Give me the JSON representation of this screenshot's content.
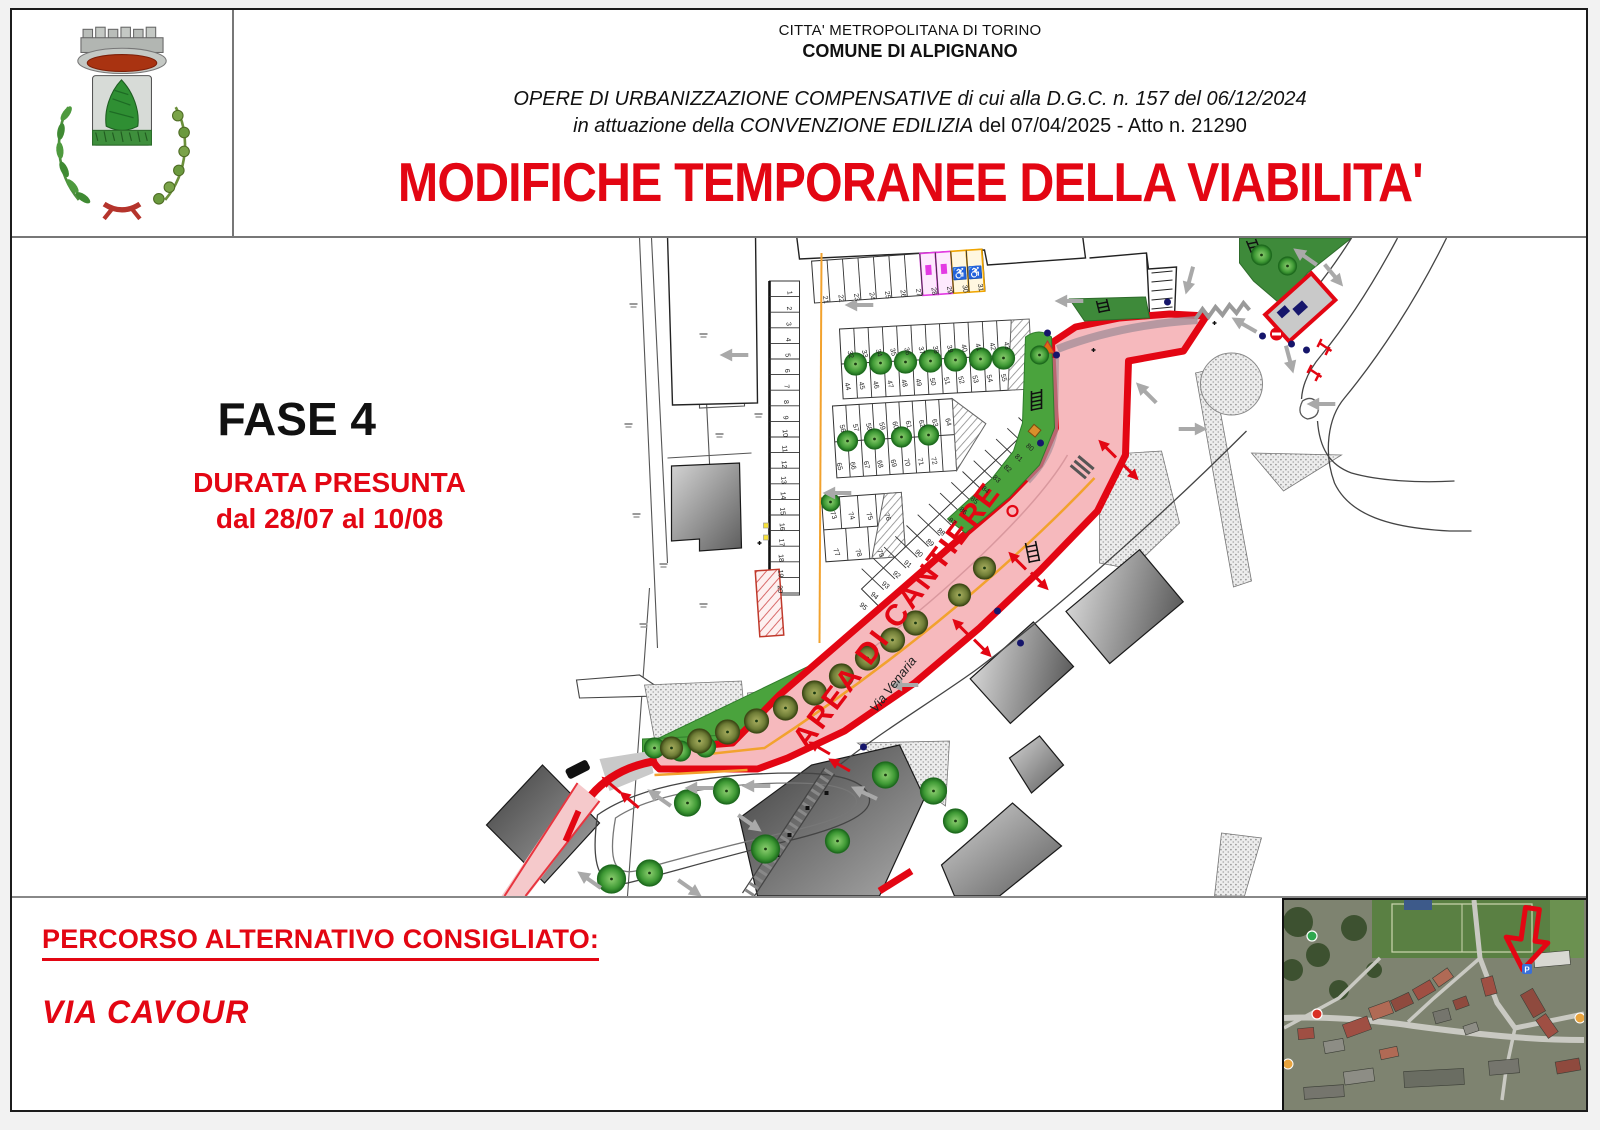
{
  "header": {
    "region_line": "CITTA' METROPOLITANA DI TORINO",
    "municipality_line": "COMUNE DI ALPIGNANO",
    "works_line": "OPERE DI URBANIZZAZIONE COMPENSATIVE di cui alla D.G.C. n. 157 del 06/12/2024",
    "agreement_line_italic": "in attuazione della CONVENZIONE EDILIZIA",
    "agreement_line_regular": "del 07/04/2025 - Atto n. 21290",
    "title": "MODIFICHE TEMPORANEE DELLA VIABILITA'"
  },
  "phase": {
    "name": "FASE 4",
    "duration_heading": "DURATA PRESUNTA",
    "duration_dates": "dal 28/07 al 10/08"
  },
  "map": {
    "construction_area_label": "AREA DI CANTIERE",
    "street_label": "Via Venaria",
    "accessible_stall_symbol": "♿",
    "stall_numbers": {
      "left_column": [
        1,
        20
      ],
      "top_row": [
        21,
        31
      ],
      "row_a_upper": [
        32,
        43
      ],
      "row_a_lower": [
        44,
        55
      ],
      "row_b_upper": [
        56,
        64
      ],
      "row_b_lower": [
        65,
        72
      ],
      "row_c_upper": [
        73,
        76
      ],
      "row_c_lower": [
        77,
        79
      ],
      "diagonal_row": [
        80,
        95
      ]
    }
  },
  "footer": {
    "alternative_route_heading": "PERCORSO ALTERNATIVO CONSIGLIATO:",
    "alternative_route_street": "VIA CAVOUR"
  },
  "colors": {
    "accent_red": "#e30613",
    "zone_fill_pink": "#f6b9bd",
    "landscape_green": "#4aa33d",
    "ev_stall_magenta": "#e33ae3",
    "accessible_stall_orange": "#f0a500",
    "centerline_orange": "#f2a22e"
  }
}
